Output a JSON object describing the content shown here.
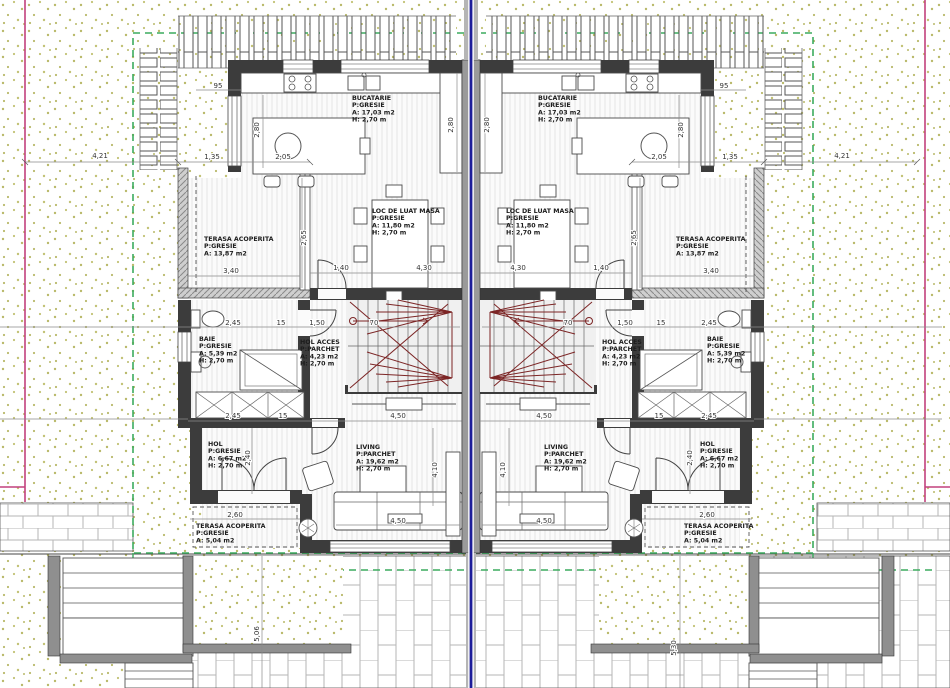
{
  "drawing": {
    "type": "architectural-floor-plan",
    "units": 2,
    "mirrored": true
  },
  "colors": {
    "background": "#ffffff",
    "dot_hatch": "#b9b96a",
    "wall_dark": "#3c3c3c",
    "wall_gray": "#8f8f8f",
    "party_wall_blue": "#1d1d99",
    "boundary_green": "#3cab5e",
    "property_line_magenta": "#c2417d",
    "stair_red": "#7c2525",
    "paving_joint": "#b5b5b5",
    "floor_hatch": "#e6e6e6",
    "dim_gray": "#8a8a8a"
  },
  "rooms": [
    {
      "id": "bucatarie",
      "x": 352,
      "y": 100,
      "w": 52,
      "lines": [
        "BUCATARIE",
        "P:GRESIE",
        "A: 17,03 m2",
        "H: 2,70 m"
      ]
    },
    {
      "id": "loc-de-luat-masa",
      "x": 372,
      "y": 213,
      "w": 64,
      "lines": [
        "LOC DE LUAT MASA",
        "P:GRESIE",
        "A: 11,80 m2",
        "H: 2,70 m"
      ]
    },
    {
      "id": "terasa-acoperita-nord",
      "x": 204,
      "y": 241,
      "w": 62,
      "lines": [
        "TERASA ACOPERITA",
        "P:GRESIE",
        "A: 13,87 m2"
      ]
    },
    {
      "id": "baie",
      "x": 199,
      "y": 341,
      "w": 36,
      "lines": [
        "BAIE",
        "P:GRESIE",
        "A: 5,39 m2",
        "H: 2,70 m"
      ]
    },
    {
      "id": "hol-acces",
      "x": 300,
      "y": 344,
      "w": 40,
      "lines": [
        "HOL ACCES",
        "P:PARCHET",
        "A: 4,23 m2",
        "H: 2,70 m"
      ]
    },
    {
      "id": "hol",
      "x": 208,
      "y": 446,
      "w": 34,
      "lines": [
        "HOL",
        "P:GRESIE",
        "A: 6,67 m2",
        "H: 2,70 m"
      ]
    },
    {
      "id": "living",
      "x": 356,
      "y": 449,
      "w": 42,
      "lines": [
        "LIVING",
        "P:PARCHET",
        "A: 19,62 m2",
        "H: 2,70 m"
      ]
    },
    {
      "id": "terasa-acoperita-sud",
      "x": 196,
      "y": 528,
      "w": 62,
      "lines": [
        "TERASA ACOPERITA",
        "P:GRESIE",
        "A: 5,04 m2"
      ]
    }
  ],
  "dims": [
    {
      "t": "4,21",
      "x": 100,
      "y": 158,
      "r": 0,
      "m": true
    },
    {
      "t": "95",
      "x": 218,
      "y": 88,
      "r": 0,
      "m": true
    },
    {
      "t": "1,35",
      "x": 212,
      "y": 159,
      "r": 0,
      "m": true
    },
    {
      "t": "2,05",
      "x": 283,
      "y": 159,
      "r": 0,
      "m": true
    },
    {
      "t": "2,80",
      "x": 259,
      "y": 130,
      "r": 90,
      "m": true
    },
    {
      "t": "2,80",
      "x": 453,
      "y": 125,
      "r": 90,
      "m": true
    },
    {
      "t": "2,65",
      "x": 306,
      "y": 238,
      "r": 90,
      "m": true
    },
    {
      "t": "3,40",
      "x": 231,
      "y": 273,
      "r": 0,
      "m": true
    },
    {
      "t": "1,40",
      "x": 341,
      "y": 270,
      "r": 0,
      "m": true
    },
    {
      "t": "4,30",
      "x": 424,
      "y": 270,
      "r": 0,
      "m": true
    },
    {
      "t": "2,45",
      "x": 233,
      "y": 325,
      "r": 0,
      "m": true
    },
    {
      "t": "15",
      "x": 281,
      "y": 325,
      "r": 0,
      "m": true
    },
    {
      "t": "1,50",
      "x": 317,
      "y": 325,
      "r": 0,
      "m": true
    },
    {
      "t": "70",
      "x": 374,
      "y": 325,
      "r": 0,
      "m": true
    },
    {
      "t": "2,45",
      "x": 233,
      "y": 418,
      "r": 0,
      "m": true
    },
    {
      "t": "15",
      "x": 283,
      "y": 418,
      "r": 0,
      "m": true
    },
    {
      "t": "4,50",
      "x": 398,
      "y": 418,
      "r": 0,
      "m": true
    },
    {
      "t": "4,50",
      "x": 398,
      "y": 523,
      "r": 0,
      "m": true
    },
    {
      "t": "2,60",
      "x": 235,
      "y": 517,
      "r": 0,
      "m": true
    },
    {
      "t": "2,40",
      "x": 250,
      "y": 458,
      "r": 90,
      "m": true
    },
    {
      "t": "4,10",
      "x": 437,
      "y": 470,
      "r": 90,
      "m": true
    },
    {
      "t": "5,06",
      "x": 259,
      "y": 634,
      "r": 90,
      "m": false
    },
    {
      "t": "5,30",
      "x": 676,
      "y": 648,
      "r": 90,
      "m": false
    }
  ]
}
